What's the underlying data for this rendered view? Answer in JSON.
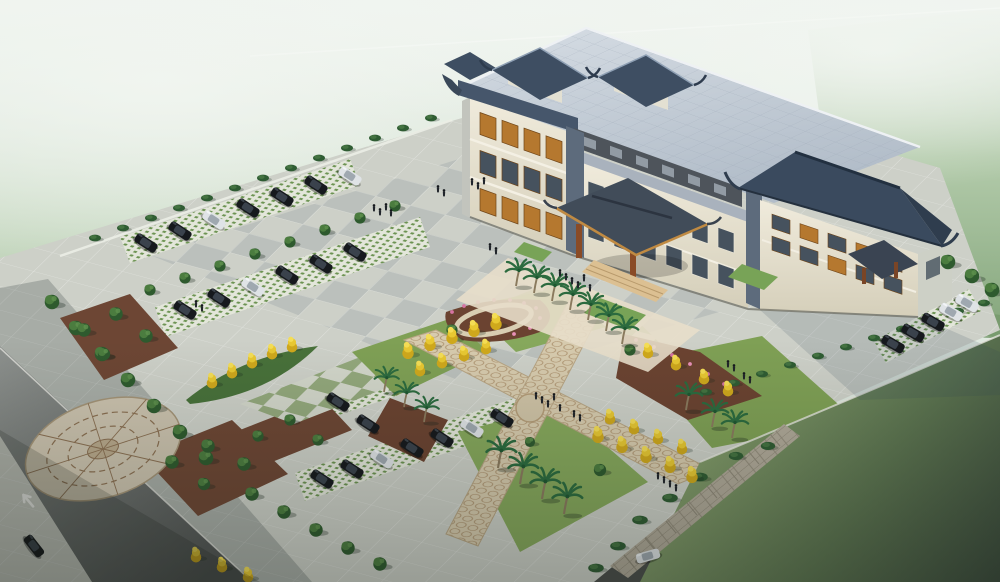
{
  "scene": {
    "title": "Aerial architectural rendering of a Chinese-style civic building complex",
    "description": "Bird's-eye 3D rendering: a three-storey cream building with traditional blue-grey Chinese tiled roofs and rooftop pavilions, hip-roof entrance porte-cochere with timber columns, a large light-grey paved plaza with checkerboard accents, an X-shaped garden of ginkgo and palm trees with flower beds, grass-grid parking stalls filled with dark sedans, a decorative circular paving medallion, perimeter roads with a lane arrow, and misty green countryside fading to haze.",
    "building": {
      "style": "traditional Chinese eaved roofs on modern block",
      "floors_visible": 3,
      "rooftop_pavilions": 3,
      "entrance": "hip-roof porte-cochere with timber columns and steps",
      "window_accent": "orange timber lattice"
    },
    "site": {
      "plaza_paving": "light grey granite tiles with darker checker accents",
      "walkway_paving": "green and grey checkerboard",
      "garden_layout": "X-shaped patterned paths with lawns, mulch beds and pink flowers",
      "feature": "circular fan-pattern paving medallion",
      "edge": "stone retaining wall with steps to lawn"
    },
    "counts": {
      "cars_left_lot": 15,
      "cars_south_lot": 7,
      "cars_east_lot": 5,
      "cars_on_road": 2,
      "cars_total": 29,
      "palm_trees": 17,
      "ginkgo_trees": 30,
      "deciduous_trees": 38,
      "hedge_shrubs": 31,
      "people_approx": 34
    },
    "road": {
      "marking": "white lane arrow"
    },
    "palette": {
      "mist": "#e7eee8",
      "forest": "#87a87e",
      "lawn": "#7fa055",
      "dark_grass": "#3e4f3a",
      "plaza_tile": "#d2d5cc",
      "checker_green": "#93a87c",
      "path_beige": "#d7cbae",
      "mulch": "#6b4331",
      "flower_pink": "#d674a2",
      "ginkgo_yellow": "#e8c832",
      "facade_cream": "#e9e4d4",
      "roof_light": "#c6cdd8",
      "roof_dark": "#3a4a5e",
      "timber_orange": "#b5782f",
      "asphalt": "#7e8284",
      "car_dark": "#16191d",
      "car_white": "#dfe3e6"
    }
  }
}
